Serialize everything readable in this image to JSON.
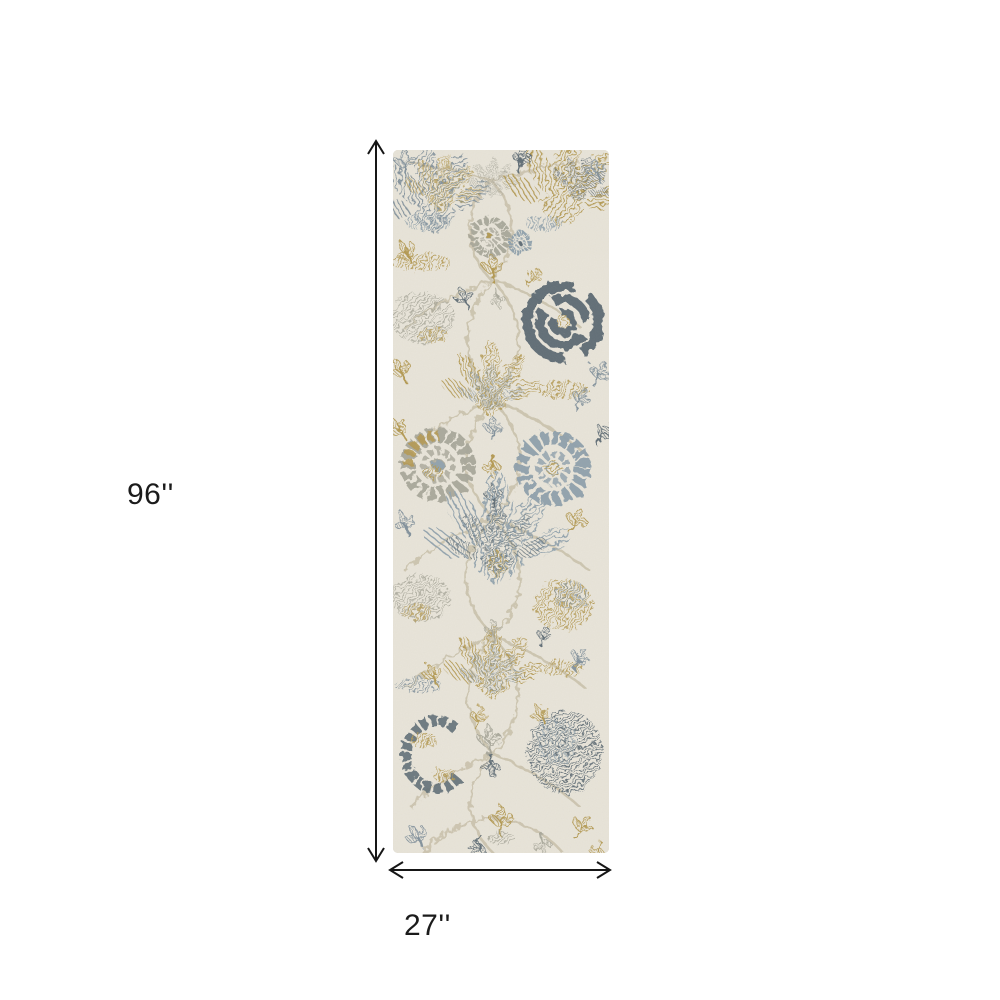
{
  "page": {
    "background_color": "#ffffff"
  },
  "product_image": {
    "description": "runner rug with distressed floral oushak pattern",
    "palette": {
      "rug_ground": "#e9e5da",
      "slate_blue": "#7e8e9a",
      "light_blue_gray": "#8ea0ac",
      "dark_slate": "#5a6872",
      "gold": "#b2974d",
      "silver_gray": "#a8a79a",
      "vine_tan": "#cbc3ad"
    }
  },
  "dimensions": {
    "height_label": "96''",
    "width_label": "27''",
    "arrow_color": "#161616",
    "label_color": "#1b1b1b"
  }
}
